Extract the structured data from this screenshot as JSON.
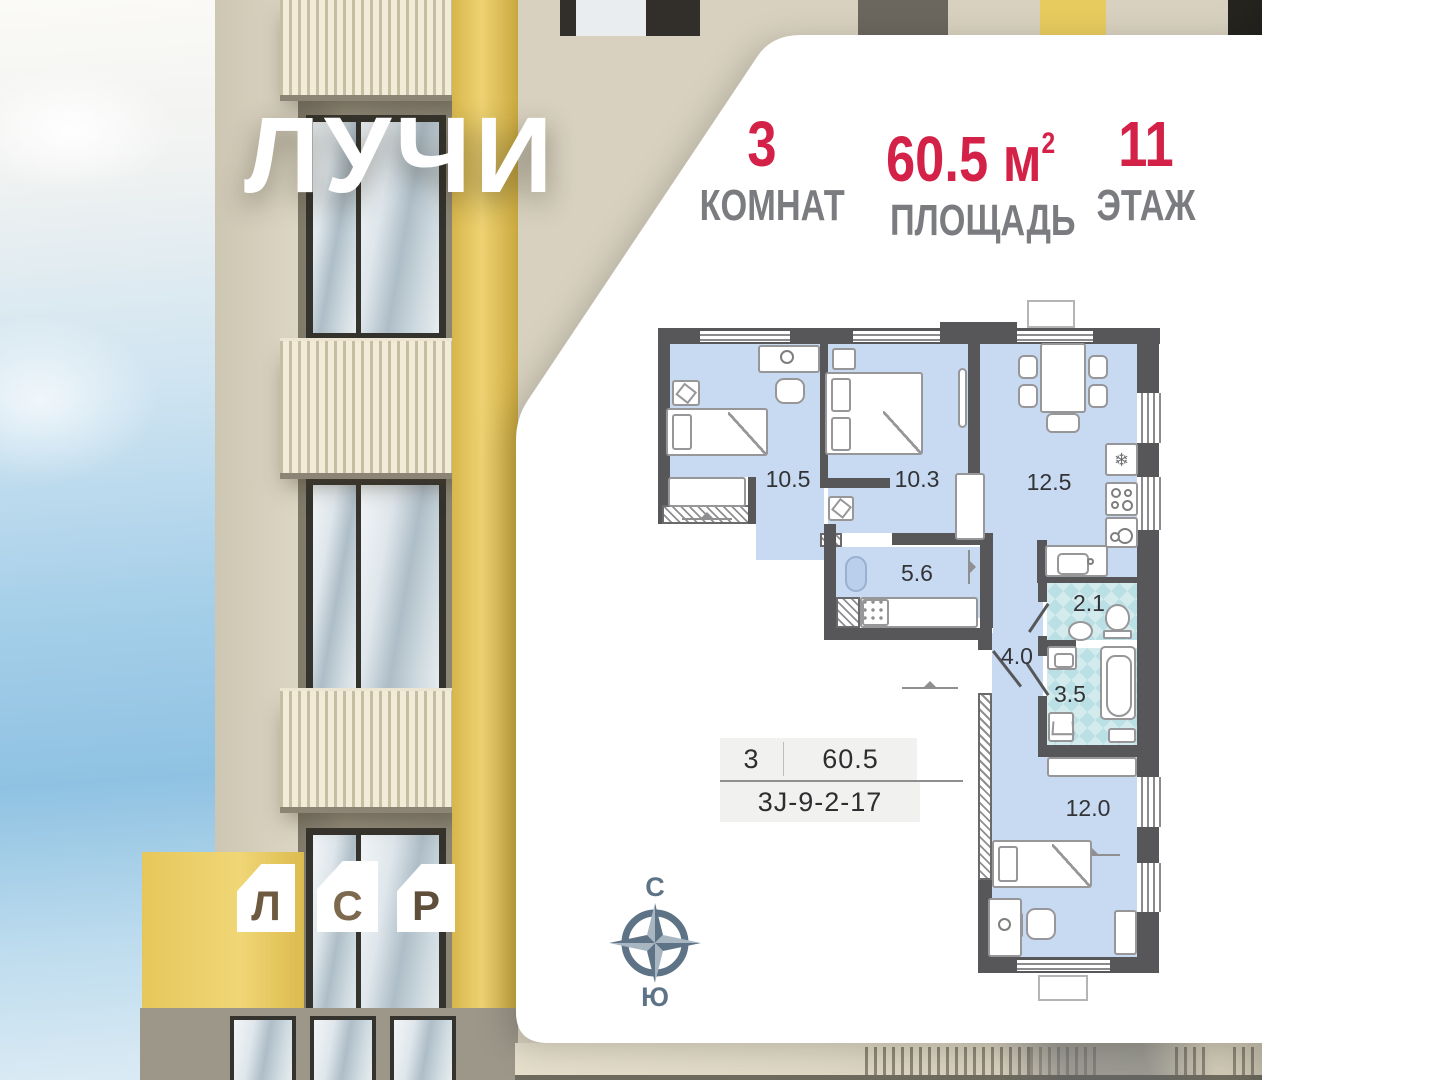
{
  "brand": {
    "project_logo": "ЛУЧИ",
    "developer": {
      "letters": [
        "Л",
        "С",
        "Р"
      ]
    }
  },
  "header": {
    "stats": [
      {
        "value": "3",
        "label": "КОМНАТ"
      },
      {
        "value": "60.5",
        "unit": "м",
        "unit_sup": "2",
        "label": "ПЛОЩАДЬ"
      },
      {
        "value": "11",
        "label": "ЭТАЖ"
      }
    ]
  },
  "floorplan": {
    "room_areas": {
      "bedroom1": "10.5",
      "bedroom2": "10.3",
      "kitchen": "12.5",
      "hall": "5.6",
      "wc": "2.1",
      "corridor": "4.0",
      "bathroom": "3.5",
      "bedroom3": "12.0"
    }
  },
  "apartment_card": {
    "rooms": "3",
    "area": "60.5",
    "code": "3J-9-2-17"
  },
  "compass": {
    "north_label": "С",
    "south_label": "Ю"
  },
  "colors": {
    "accent_red": "#d42147",
    "label_gray": "#7b7c7f",
    "wall": "#57575a",
    "room_fill": "#c8daf2",
    "wet_room_fill": "#badfe4"
  }
}
